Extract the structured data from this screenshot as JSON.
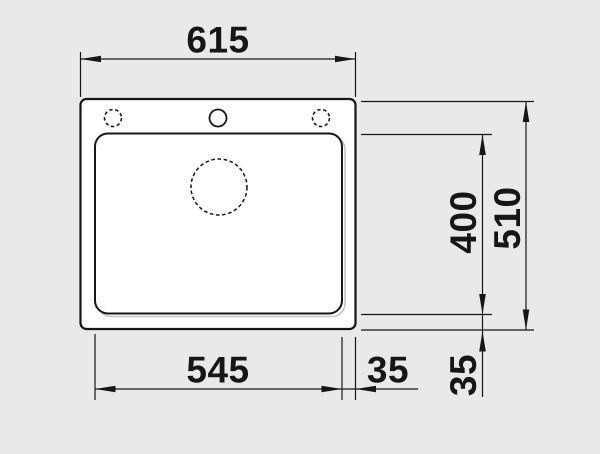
{
  "drawing": {
    "kind": "sink-installation-top-view",
    "background_color": "#e9e9e9",
    "surface_color": "#ffffff",
    "line_color": "#161616",
    "dimensions": {
      "overall_width_mm": "615",
      "overall_depth_mm": "510",
      "bowl_width_mm": "545",
      "bowl_depth_mm": "400",
      "bowl_right_offset_mm": "35",
      "bowl_bottom_offset_mm": "35"
    },
    "shapes": {
      "sink_outline": "rounded-rectangle",
      "bowl_outline": "rounded-rectangle",
      "tap_holes": [
        "dashed-circle",
        "solid-circle",
        "dashed-circle"
      ],
      "drain": "dashed-circle"
    }
  }
}
